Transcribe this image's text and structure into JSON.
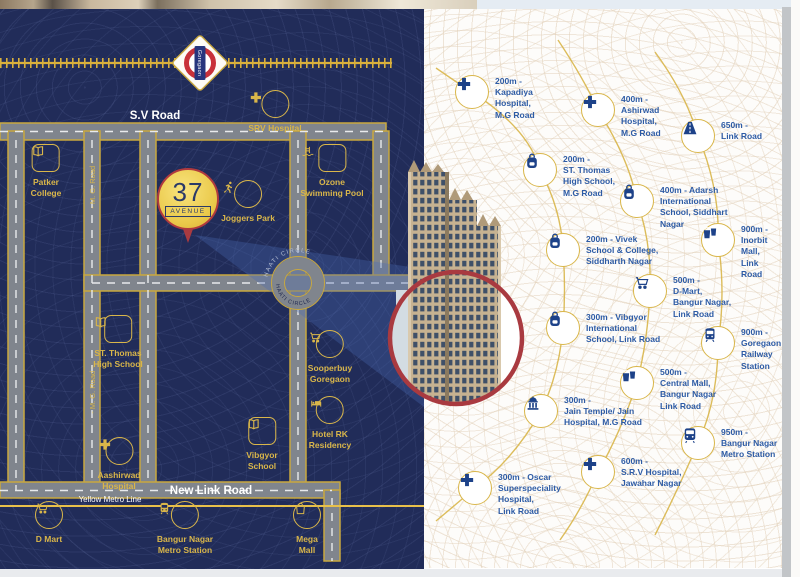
{
  "colors": {
    "map_navy": "#212c59",
    "gold": "#d9b64a",
    "road_grey": "#80858d",
    "circle_red": "#a93a40",
    "poi_text_blue": "#2d5ba5",
    "metro_yellow": "#e8c04a"
  },
  "map": {
    "station_logo": "Goregaon",
    "pin": {
      "number": "37",
      "name": "AVENUE"
    },
    "labels": {
      "sv_road": "S.V Road",
      "mg_road": "- M. G. Road -",
      "new_link_road": "New Link Road",
      "yellow_metro_line": "Yellow Metro Line",
      "haati_circle": "HAATI CIRCLE"
    },
    "landmarks": [
      {
        "id": "srv-hospital",
        "icon": "plus",
        "shape": "circle",
        "x": 275,
        "y": 94,
        "label": "SRV Hospital"
      },
      {
        "id": "patker-college",
        "icon": "book",
        "shape": "square",
        "x": 46,
        "y": 148,
        "label": "Patker\nCollege"
      },
      {
        "id": "ozone-swimming-pool",
        "icon": "pool",
        "shape": "square",
        "x": 332,
        "y": 148,
        "label": "Ozone\nSwimming Pool"
      },
      {
        "id": "joggers-park",
        "icon": "runner",
        "shape": "circle",
        "x": 248,
        "y": 184,
        "label": "Joggers Park"
      },
      {
        "id": "st-thomas-high-school",
        "icon": "book",
        "shape": "square",
        "x": 118,
        "y": 319,
        "label": "ST. Thomas\nHigh School"
      },
      {
        "id": "sooperbuy-goregaon",
        "icon": "cart",
        "shape": "circle",
        "x": 330,
        "y": 334,
        "label": "Sooperbuy\nGoregaon"
      },
      {
        "id": "hotel-rk-residency",
        "icon": "bed",
        "shape": "circle",
        "x": 330,
        "y": 400,
        "label": "Hotel RK\nResidency"
      },
      {
        "id": "vibgyor-school",
        "icon": "book",
        "shape": "square",
        "x": 262,
        "y": 421,
        "label": "Vibgyor\nSchool"
      },
      {
        "id": "aashirwad-hospital",
        "icon": "plus",
        "shape": "circle",
        "x": 119,
        "y": 441,
        "label": "Aashirwad\nHospital"
      },
      {
        "id": "d-mart",
        "icon": "cart",
        "shape": "circle",
        "x": 49,
        "y": 505,
        "label": "D Mart"
      },
      {
        "id": "bangur-nagar-metro-station",
        "icon": "train",
        "shape": "circle",
        "x": 185,
        "y": 505,
        "label": "Bangur Nagar\nMetro Station"
      },
      {
        "id": "mega-mall",
        "icon": "bag",
        "shape": "circle",
        "x": 307,
        "y": 505,
        "label": "Mega\nMall"
      }
    ]
  },
  "poi_panel": {
    "items": [
      {
        "id": "kapadiya-hospital",
        "icon": "plus",
        "x": 48,
        "y": 83,
        "text": "200m -\nKapadiya\nHospital,\nM.G Road"
      },
      {
        "id": "ashirwad-hospital",
        "icon": "plus",
        "x": 174,
        "y": 101,
        "text": "400m -\nAshirwad\nHospital,\nM.G Road"
      },
      {
        "id": "link-road",
        "icon": "road",
        "x": 274,
        "y": 127,
        "text": "650m -\nLink Road"
      },
      {
        "id": "st-thomas-high-school",
        "icon": "backpack",
        "x": 116,
        "y": 161,
        "text": "200m -\nST. Thomas\nHigh School,\nM.G Road"
      },
      {
        "id": "adarsh-international-school",
        "icon": "backpack",
        "x": 213,
        "y": 192,
        "text": "400m - Adarsh\nInternational\nSchool, Siddhart\nNagar"
      },
      {
        "id": "inorbit-mall",
        "icon": "mall",
        "x": 294,
        "y": 231,
        "text": "900m -\nInorbit Mall,\nLink Road"
      },
      {
        "id": "vivek-school-college",
        "icon": "backpack",
        "x": 139,
        "y": 241,
        "text": "200m - Vivek\nSchool & College,\nSiddharth Nagar"
      },
      {
        "id": "d-mart",
        "icon": "cart",
        "x": 226,
        "y": 282,
        "text": "500m -\nD-Mart,\nBangur Nagar,\nLink Road"
      },
      {
        "id": "vibgyor-international-school",
        "icon": "backpack",
        "x": 139,
        "y": 319,
        "text": "300m - Vibgyor\nInternational\nSchool, Link Road"
      },
      {
        "id": "goregaon-railway-station",
        "icon": "train",
        "x": 294,
        "y": 334,
        "text": "900m -\nGoregaon\nRailway\nStation"
      },
      {
        "id": "central-mall",
        "icon": "mall",
        "x": 213,
        "y": 374,
        "text": "500m -\nCentral Mall,\nBangur Nagar\nLink Road"
      },
      {
        "id": "jain-temple-jain-hospital",
        "icon": "temple",
        "x": 117,
        "y": 402,
        "text": "300m -\nJain Temple/ Jain\nHospital, M.G Road"
      },
      {
        "id": "bangur-nagar-metro-station",
        "icon": "metro",
        "x": 274,
        "y": 434,
        "text": "950m -\nBangur Nagar\nMetro Station"
      },
      {
        "id": "srv-hospital",
        "icon": "plus",
        "x": 174,
        "y": 463,
        "text": "600m -\nS.R.V Hospital,\nJawahar Nagar"
      },
      {
        "id": "oscar-superspeciality-hospital",
        "icon": "plus",
        "x": 51,
        "y": 479,
        "text": "300m - Oscar\nSuperspeciality\nHospital,\nLink Road"
      }
    ]
  }
}
